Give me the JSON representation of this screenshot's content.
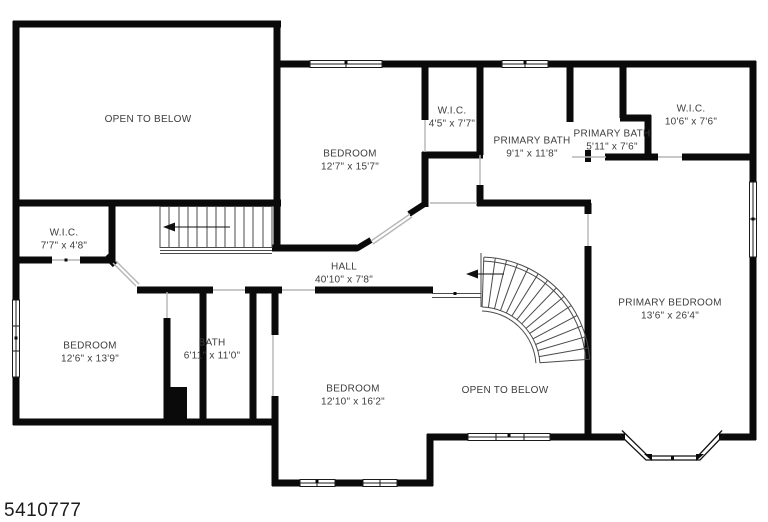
{
  "listing": {
    "id": "5410777"
  },
  "rooms": {
    "open_below_upper": {
      "name": "OPEN TO BELOW"
    },
    "bedroom_top": {
      "name": "BEDROOM",
      "dims": "12'7\" x 15'7\""
    },
    "wic_top": {
      "name": "W.I.C.",
      "dims": "4'5\" x 7'7\""
    },
    "primary_bath_large": {
      "name": "PRIMARY BATH",
      "dims": "9'1\" x 11'8\""
    },
    "primary_bath_small": {
      "name": "PRIMARY BATH",
      "dims": "5'11\" x 7'6\""
    },
    "wic_right": {
      "name": "W.I.C.",
      "dims": "10'6\" x 7'6\""
    },
    "wic_left": {
      "name": "W.I.C.",
      "dims": "7'7\" x 4'8\""
    },
    "hall": {
      "name": "HALL",
      "dims": "40'10\" x 7'8\""
    },
    "bedroom_left": {
      "name": "BEDROOM",
      "dims": "12'6\" x 13'9\""
    },
    "bath": {
      "name": "BATH",
      "dims": "6'11\" x 11'0\""
    },
    "bedroom_bottom": {
      "name": "BEDROOM",
      "dims": "12'10\" x 16'2\""
    },
    "open_below_lower": {
      "name": "OPEN TO BELOW"
    },
    "primary_bedroom": {
      "name": "PRIMARY BEDROOM",
      "dims": "13'6\" x 26'4\""
    }
  },
  "colors": {
    "wall": "#0a0a0a",
    "label": "#3d3d3d"
  }
}
